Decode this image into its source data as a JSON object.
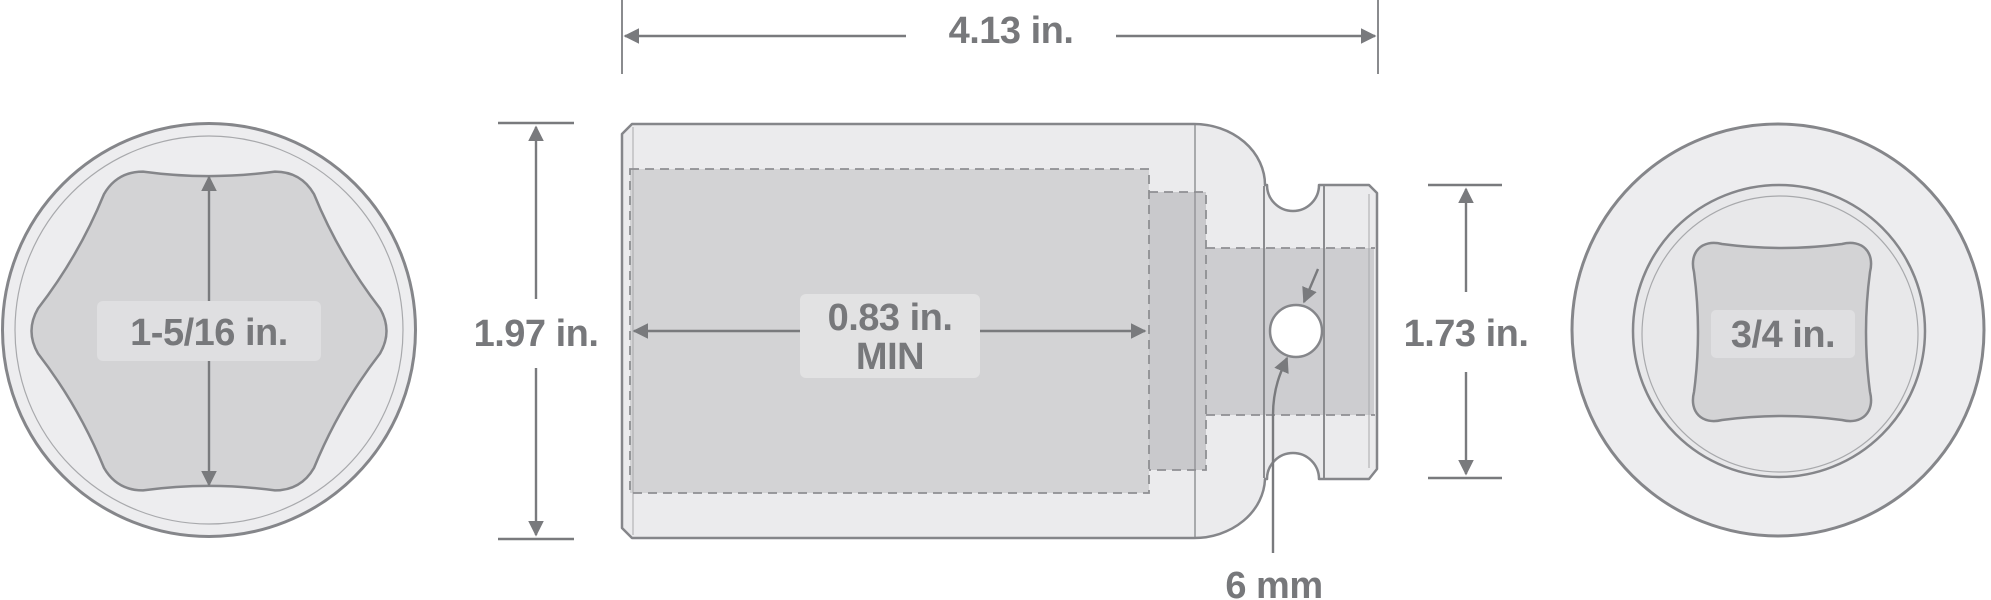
{
  "diagram": {
    "description": "impact socket technical dimension drawing, three views",
    "views": {
      "front": {
        "opening_shape": "6-point hex",
        "label": "1-5/16 in."
      },
      "side": {
        "length": "4.13 in.",
        "height": "1.97 in.",
        "bore_depth": "0.83 in.",
        "bore_depth_qualifier": "MIN",
        "drive_end_height": "1.73 in.",
        "pin_hole": "6 mm"
      },
      "rear": {
        "opening_shape": "square drive",
        "label": "3/4 in."
      }
    },
    "colors": {
      "background": "#ffffff",
      "outline": "#85868a",
      "body_fill": "#ebebed",
      "opening_fill": "#d3d3d5",
      "deep_bore_fill": "#c9c9cc",
      "dashed_line": "#8e8f92",
      "dimension_line": "#797a7d",
      "label_text": "#77787b",
      "label_panel": "#dfdfe1"
    }
  }
}
